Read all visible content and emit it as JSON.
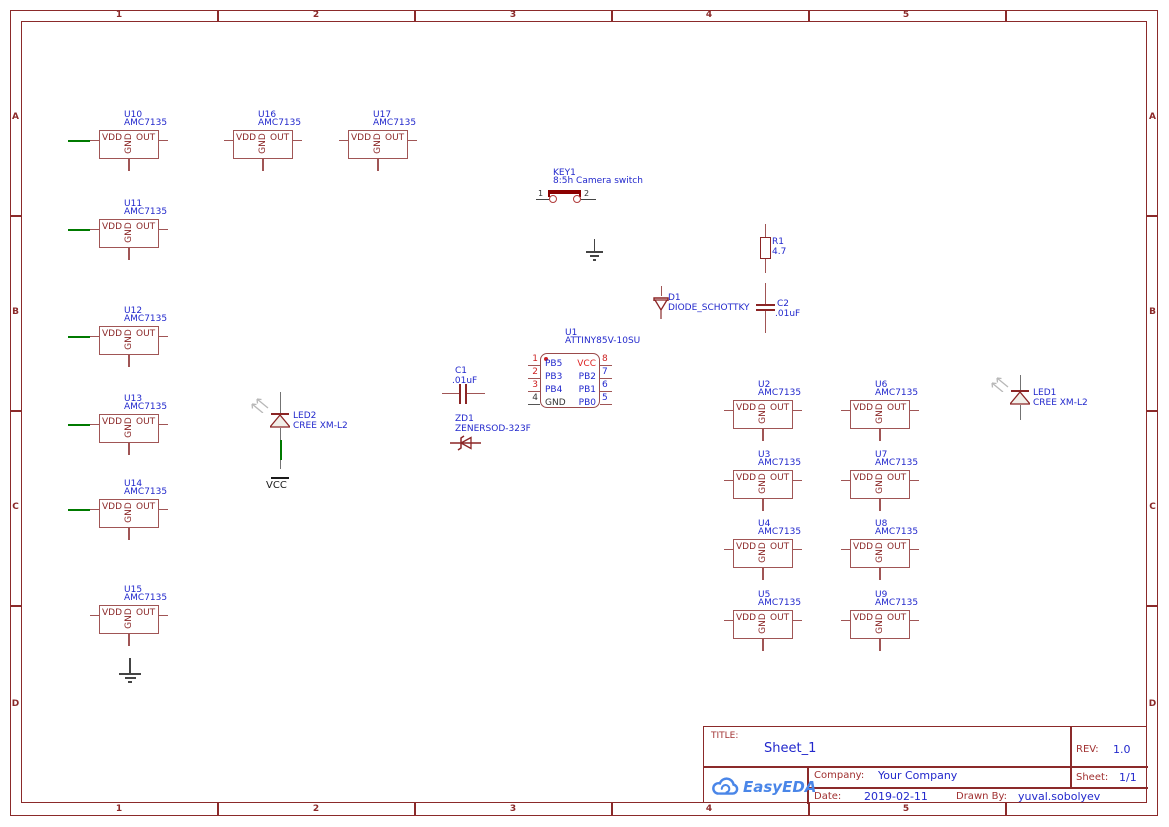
{
  "colors": {
    "frame": "#8b2a2a",
    "symbol_stroke": "#a05555",
    "symbol_dark": "#8b2525",
    "pin_text_red": "#8b2828",
    "label_blue": "#2228cc",
    "wire_green": "#007a00",
    "wire_gray": "#737373",
    "net_black": "#333333",
    "pin_red": "#cc2222",
    "switch_cap": "#8b0000",
    "led_fill": "#f2efe9",
    "logo_blue": "#4a86e8"
  },
  "frame": {
    "columns": [
      "1",
      "2",
      "3",
      "4",
      "5"
    ],
    "rows": [
      "A",
      "B",
      "C",
      "D"
    ]
  },
  "amc": {
    "value": "AMC7135",
    "pin_left": "VDD",
    "pin_mid": "GND",
    "pin_right": "OUT",
    "parts": [
      {
        "ref": "U10",
        "x": 99,
        "y": 130,
        "green": true
      },
      {
        "ref": "U16",
        "x": 233,
        "y": 130,
        "green": false
      },
      {
        "ref": "U17",
        "x": 348,
        "y": 130,
        "green": false
      },
      {
        "ref": "U11",
        "x": 99,
        "y": 219,
        "green": true
      },
      {
        "ref": "U12",
        "x": 99,
        "y": 326,
        "green": true
      },
      {
        "ref": "U13",
        "x": 99,
        "y": 414,
        "green": true
      },
      {
        "ref": "U14",
        "x": 99,
        "y": 499,
        "green": true
      },
      {
        "ref": "U15",
        "x": 99,
        "y": 605,
        "green": false
      },
      {
        "ref": "U2",
        "x": 733,
        "y": 400,
        "green": false
      },
      {
        "ref": "U6",
        "x": 850,
        "y": 400,
        "green": false
      },
      {
        "ref": "U3",
        "x": 733,
        "y": 470,
        "green": false
      },
      {
        "ref": "U7",
        "x": 850,
        "y": 470,
        "green": false
      },
      {
        "ref": "U4",
        "x": 733,
        "y": 539,
        "green": false
      },
      {
        "ref": "U8",
        "x": 850,
        "y": 539,
        "green": false
      },
      {
        "ref": "U5",
        "x": 733,
        "y": 610,
        "green": false
      },
      {
        "ref": "U9",
        "x": 850,
        "y": 610,
        "green": false
      }
    ]
  },
  "mcu": {
    "ref": "U1",
    "value": "ATTINY85V-10SU",
    "left_pins": [
      {
        "num": "1",
        "name": "PB5",
        "num_color": "#cc2222",
        "name_color": "#2228cc"
      },
      {
        "num": "2",
        "name": "PB3",
        "num_color": "#cc2222",
        "name_color": "#2228cc"
      },
      {
        "num": "3",
        "name": "PB4",
        "num_color": "#cc2222",
        "name_color": "#2228cc"
      },
      {
        "num": "4",
        "name": "GND",
        "num_color": "#333333",
        "name_color": "#333333",
        "stub_color": "#555555"
      }
    ],
    "right_pins": [
      {
        "num": "8",
        "name": "VCC",
        "num_color": "#cc2222",
        "name_color": "#dd2222"
      },
      {
        "num": "7",
        "name": "PB2",
        "num_color": "#2228cc",
        "name_color": "#2228cc"
      },
      {
        "num": "6",
        "name": "PB1",
        "num_color": "#2228cc",
        "name_color": "#2228cc"
      },
      {
        "num": "5",
        "name": "PB0",
        "num_color": "#2228cc",
        "name_color": "#2228cc"
      }
    ]
  },
  "key1": {
    "ref": "KEY1",
    "value": "8:5h Camera switch",
    "pin1": "1",
    "pin2": "2"
  },
  "c1": {
    "ref": "C1",
    "value": ".01uF"
  },
  "zd1": {
    "ref": "ZD1",
    "value": "ZENERSOD-323F"
  },
  "r1": {
    "ref": "R1",
    "value": "4.7"
  },
  "d1": {
    "ref": "D1",
    "value": "DIODE_SCHOTTKY"
  },
  "c2": {
    "ref": "C2",
    "value": ".01uF"
  },
  "led1": {
    "ref": "LED1",
    "value": "CREE XM-L2"
  },
  "led2": {
    "ref": "LED2",
    "value": "CREE XM-L2"
  },
  "vcc_net": "VCC",
  "title_block": {
    "title_label": "TITLE:",
    "title": "Sheet_1",
    "rev_label": "REV:",
    "rev": "1.0",
    "company_label": "Company:",
    "company": "Your Company",
    "sheet_label": "Sheet:",
    "sheet": "1/1",
    "date_label": "Date:",
    "date": "2019-02-11",
    "drawn_label": "Drawn By:",
    "drawn_by": "yuval.sobolyev",
    "logo": "EasyEDA"
  }
}
